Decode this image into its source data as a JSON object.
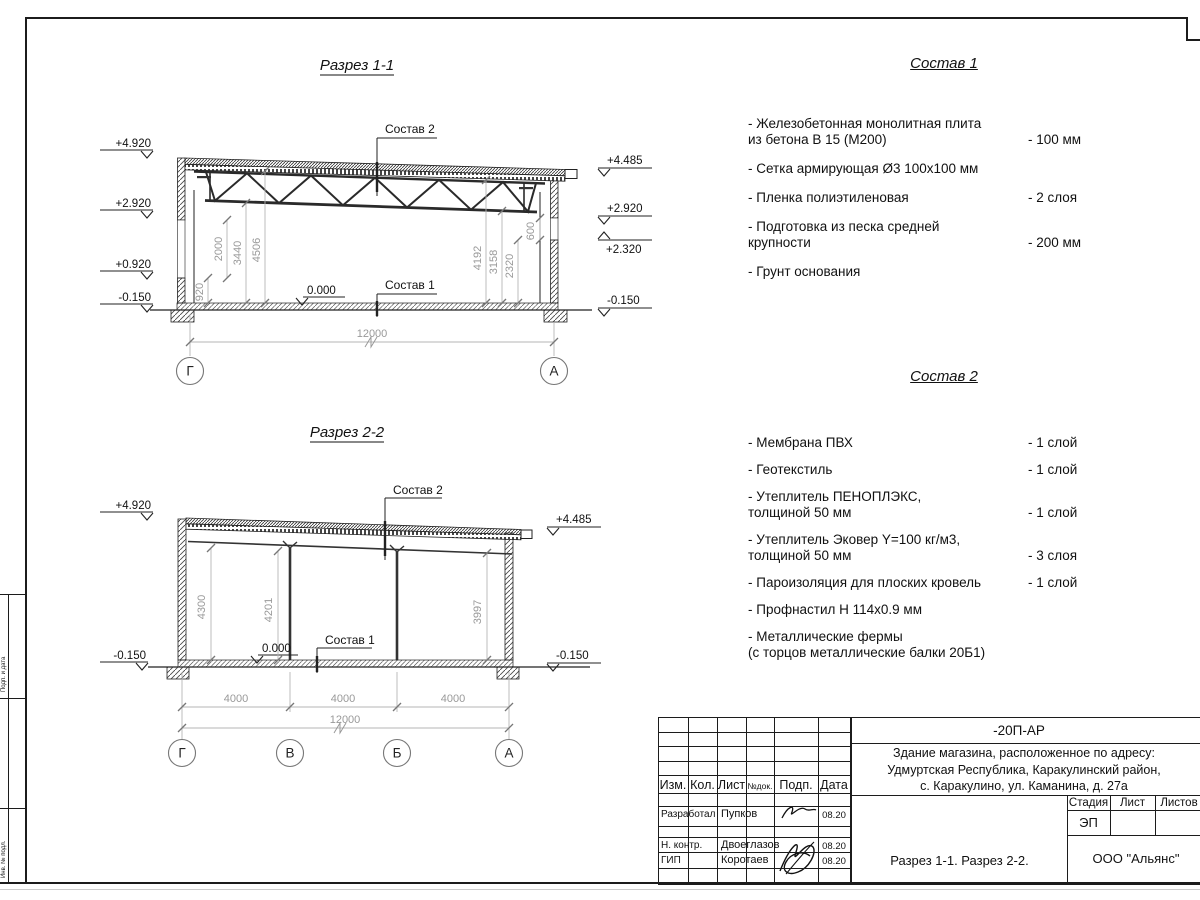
{
  "section1": {
    "title": "Разрез 1-1",
    "callout_top": "Состав 2",
    "callout_bottom": "Состав 1",
    "zero_mark": "0.000",
    "elevations_left": [
      "+4.920",
      "+2.920",
      "+0.920",
      "-0.150"
    ],
    "elevations_right": [
      "+4.485",
      "+2.920",
      "+2.320",
      "-0.150"
    ],
    "dims_left": [
      "920",
      "2000",
      "3440",
      "4506"
    ],
    "dims_right": [
      "4192",
      "3158",
      "2320",
      "600"
    ],
    "dim_overall": "12000",
    "axes": [
      "Г",
      "А"
    ]
  },
  "section2": {
    "title": "Разрез 2-2",
    "callout_top": "Состав 2",
    "callout_bottom": "Состав 1",
    "zero_mark": "0.000",
    "elevations_left": [
      "+4.920",
      "-0.150"
    ],
    "elevations_right": [
      "+4.485",
      "-0.150"
    ],
    "dims_vertical": [
      "4300",
      "4201",
      "3997"
    ],
    "dims_bays": [
      "4000",
      "4000",
      "4000"
    ],
    "dim_overall": "12000",
    "axes": [
      "Г",
      "В",
      "Б",
      "А"
    ]
  },
  "composition1": {
    "title": "Состав 1",
    "items": [
      {
        "name": "- Железобетонная  монолитная плита\n  из бетона В 15 (М200)",
        "qty": "- 100 мм"
      },
      {
        "name": "- Сетка армирующая Ø3 100х100 мм",
        "qty": ""
      },
      {
        "name": "- Пленка полиэтиленовая",
        "qty": "-  2 слоя"
      },
      {
        "name": "- Подготовка из песка средней\n  крупности",
        "qty": "- 200 мм"
      },
      {
        "name": "- Грунт основания",
        "qty": ""
      }
    ]
  },
  "composition2": {
    "title": "Состав 2",
    "items": [
      {
        "name": "- Мембрана ПВХ",
        "qty": "- 1 слой"
      },
      {
        "name": "- Геотекстиль",
        "qty": "- 1 слой"
      },
      {
        "name": "- Утеплитель ПЕНОПЛЭКС,\n  толщиной 50 мм",
        "qty": "- 1 слой"
      },
      {
        "name": "- Утеплитель Эковер Y=100 кг/м3,\n  толщиной 50 мм",
        "qty": "- 3 слоя"
      },
      {
        "name": "- Пароизоляция для плоских кровель",
        "qty": "- 1 слой"
      },
      {
        "name": "- Профнастил Н 114х0.9 мм",
        "qty": ""
      },
      {
        "name": "- Металлические фермы\n  (с торцов металлические балки 20Б1)",
        "qty": ""
      }
    ]
  },
  "titleblock": {
    "code": "-20П-АР",
    "project": "Здание магазина, расположенное по адресу:\nУдмуртская Республика, Каракулинский район,\nс. Каракулино, ул. Каманина, д. 27а",
    "columns": [
      "Изм.",
      "Кол.",
      "Лист",
      "№док.",
      "Подп.",
      "Дата"
    ],
    "rows": [
      {
        "role": "Разработал",
        "name": "Пупков",
        "date": "08.20"
      },
      {
        "role": "Н. контр.",
        "name": "Двоеглазов",
        "date": "08.20"
      },
      {
        "role": "ГИП",
        "name": "Коротаев",
        "date": "08.20"
      }
    ],
    "stage_columns": [
      "Стадия",
      "Лист",
      "Листов"
    ],
    "stage_value": "ЭП",
    "drawing_title": "Разрез 1-1. Разрез 2-2.",
    "company": "ООО \"Альянс\""
  },
  "frame_stamp": {
    "box1": "Подп. и дата",
    "box3": "Инв. № подл."
  },
  "colors": {
    "line": "#1c1c1c",
    "dim_text": "#999999",
    "paper": "#ffffff"
  }
}
